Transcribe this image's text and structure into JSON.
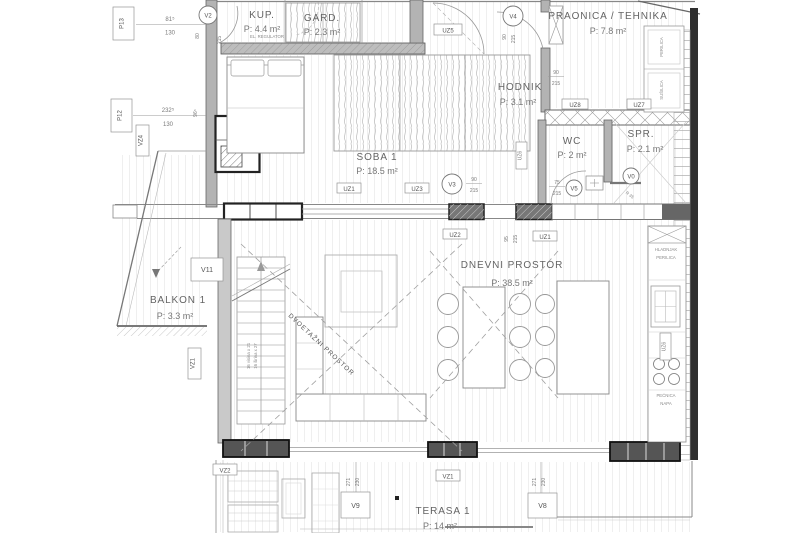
{
  "plan": {
    "rooms": {
      "kup": {
        "name": "KUP.",
        "area": "P: 4.4 m²"
      },
      "gard": {
        "name": "GARD.",
        "area": "P: 2.3 m²"
      },
      "praonica": {
        "name": "PRAONICA / TEHNIKA",
        "area": "P: 7.8 m²"
      },
      "hodnik": {
        "name": "HODNIK",
        "area": "P: 3.1 m²"
      },
      "soba1": {
        "name": "SOBA 1",
        "area": "P: 18.5 m²"
      },
      "wc": {
        "name": "WC",
        "area": "P: 2 m²"
      },
      "spr": {
        "name": "SPR.",
        "area": "P: 2.1 m²"
      },
      "dnevni": {
        "name": "DNEVNI PROSTOR",
        "area": "P: 38.5 m²"
      },
      "balkon1": {
        "name": "BALKON 1",
        "area": "P: 3.3 m²"
      },
      "terasa1": {
        "name": "TERASA 1",
        "area": "P: 14 m²"
      }
    },
    "doors": {
      "v0": {
        "label": "V0"
      },
      "v2": {
        "label": "V2",
        "w": "80",
        "h": "215"
      },
      "v3": {
        "label": "V3",
        "w": "90",
        "h": "215"
      },
      "v4": {
        "label": "V4",
        "w": "90",
        "h": "215"
      },
      "v5": {
        "label": "V5",
        "w": "75",
        "h": "215"
      }
    },
    "windows": {
      "v8": {
        "label": "V8",
        "w": "271",
        "h": "230"
      },
      "v9": {
        "label": "V9",
        "w": "271",
        "h": "230"
      },
      "v11": {
        "label": "V11"
      }
    },
    "walls": {
      "uz1a": "UZ1",
      "uz1b": "UZ1",
      "uz2": "UZ2",
      "uz3": "UZ3",
      "uz5": "UZ5",
      "uz6a": "UZ6",
      "uz6b": "UZ6",
      "uz7": "UZ7",
      "uz8": "UZ8",
      "vz1a": "VZ1",
      "vz1b": "VZ1",
      "vz2": "VZ2",
      "vz4": "VZ4"
    },
    "panels": {
      "p13": {
        "label": "P13",
        "w": "81⁵",
        "h": "130"
      },
      "p12": {
        "label": "P12",
        "w": "232⁵",
        "h": "130",
        "side": "96⁵"
      }
    },
    "openings": {
      "hodnik": {
        "w": "90",
        "h": "215"
      },
      "uz1": {
        "w": "95",
        "h": "215"
      }
    },
    "annotations": {
      "dvoetazni": "DVOETAŽNI PROSTOR",
      "el_regulator": "EL. REGULATOR",
      "stairs1": "16 visina x 21",
      "stairs2": "16 širina x 27",
      "hladnjak": "HLADNJAK",
      "perilica_kitchen": "PERILICA",
      "pecnica": "PEĆNICA",
      "napa": "NAPA",
      "perilica": "PERILICA",
      "susilica": "SUŠILICA",
      "r35": "R 35"
    },
    "colors": {
      "wall_dark": "#2f2f2f",
      "wall_mid": "#b3b3b3",
      "line": "#999999",
      "text": "#6a6a6a"
    }
  }
}
